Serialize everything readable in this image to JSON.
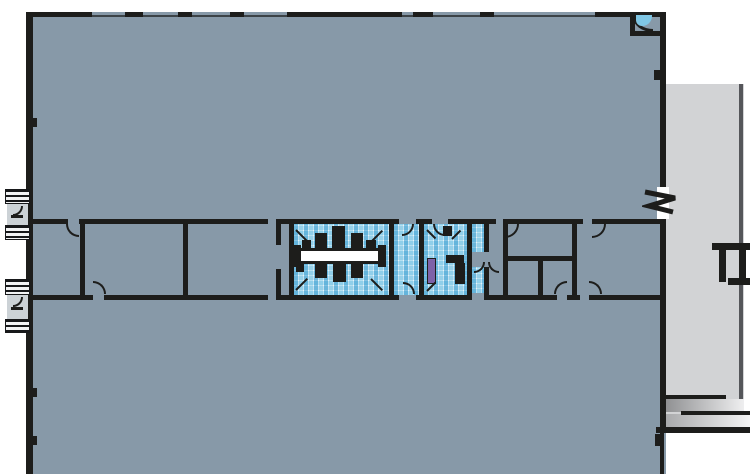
{
  "canvas": {
    "width": 750,
    "height": 474
  },
  "colors": {
    "background": "#ffffff",
    "floor": "#8799a8",
    "wing": "#d2d3d5",
    "wingEdge": "#55565a",
    "wall": "#1d1d1b",
    "wallThin": "#3c4347",
    "white": "#ffffff",
    "tileBase": "#bfe1f1",
    "tileMid": "#6fc0e4",
    "tileDark": "#3e9fd0",
    "basin": "#7fc6e4",
    "purple": "#7e62a8",
    "landing": "#ccd2d6",
    "rampDark": "#8f9092",
    "rampLight": "#efeff0"
  },
  "elements": [
    {
      "n": "main-floor-area",
      "x": 26,
      "y": 12,
      "w": 640,
      "h": 462,
      "f": "floor"
    },
    {
      "n": "right-wing-floor",
      "x": 666,
      "y": 84,
      "w": 78,
      "h": 346,
      "f": "wing"
    },
    {
      "n": "right-wing-edge-line",
      "x": 739,
      "y": 84,
      "w": 4,
      "h": 333,
      "f": "wingEdge"
    },
    {
      "n": "loading-ramp-upper",
      "x": 665,
      "y": 399,
      "w": 79,
      "h": 13,
      "g": [
        "#8f9092",
        "#efeff0"
      ]
    },
    {
      "n": "loading-ramp-lower",
      "x": 665,
      "y": 414,
      "w": 85,
      "h": 13,
      "g": [
        "#a8a9ab",
        "#f4f4f4"
      ]
    },
    {
      "n": "dock-edge-line",
      "x": 664,
      "y": 395,
      "w": 62,
      "h": 4,
      "f": "wall"
    },
    {
      "n": "dock-edge-line",
      "x": 681,
      "y": 411,
      "w": 69,
      "h": 4,
      "f": "wall"
    },
    {
      "n": "dock-edge-line",
      "x": 656,
      "y": 427,
      "w": 94,
      "h": 6,
      "f": "wall"
    },
    {
      "n": "restroom-tile-floor-west",
      "x": 294,
      "y": 224,
      "w": 95,
      "h": 71,
      "m": 1
    },
    {
      "n": "restroom-vestibule-tile",
      "x": 394,
      "y": 224,
      "w": 25,
      "h": 71,
      "m": 1
    },
    {
      "n": "restroom-tile-floor-east",
      "x": 424,
      "y": 224,
      "w": 43,
      "h": 71,
      "m": 1
    },
    {
      "n": "restroom-tile-sliver",
      "x": 472,
      "y": 224,
      "w": 12,
      "h": 28,
      "m": 1
    },
    {
      "n": "restroom-tile-sliver",
      "x": 472,
      "y": 267,
      "w": 12,
      "h": 26,
      "m": 1
    },
    {
      "n": "counter-edge",
      "x": 296,
      "y": 248,
      "w": 86,
      "h": 3,
      "f": "wall"
    },
    {
      "n": "restroom-counter",
      "x": 296,
      "y": 251,
      "w": 86,
      "h": 10,
      "f": "white"
    },
    {
      "n": "counter-edge",
      "x": 296,
      "y": 261,
      "w": 86,
      "h": 3,
      "f": "wall"
    },
    {
      "n": "counter-end-block",
      "x": 293,
      "y": 245,
      "w": 8,
      "h": 22,
      "f": "wall"
    },
    {
      "n": "counter-end-block",
      "x": 378,
      "y": 245,
      "w": 8,
      "h": 22,
      "f": "wall"
    },
    {
      "n": "plumbing-fixture",
      "x": 302,
      "y": 240,
      "w": 9,
      "h": 9,
      "f": "wall"
    },
    {
      "n": "plumbing-fixture",
      "x": 315,
      "y": 233,
      "w": 12,
      "h": 16,
      "f": "wall"
    },
    {
      "n": "plumbing-fixture",
      "x": 332,
      "y": 226,
      "w": 13,
      "h": 23,
      "f": "wall"
    },
    {
      "n": "plumbing-fixture",
      "x": 351,
      "y": 233,
      "w": 12,
      "h": 16,
      "f": "wall"
    },
    {
      "n": "plumbing-fixture",
      "x": 366,
      "y": 240,
      "w": 10,
      "h": 9,
      "f": "wall"
    },
    {
      "n": "plumbing-fixture",
      "x": 296,
      "y": 263,
      "w": 8,
      "h": 9,
      "f": "wall"
    },
    {
      "n": "plumbing-fixture",
      "x": 315,
      "y": 263,
      "w": 12,
      "h": 15,
      "f": "wall"
    },
    {
      "n": "plumbing-fixture",
      "x": 333,
      "y": 263,
      "w": 13,
      "h": 19,
      "f": "wall"
    },
    {
      "n": "plumbing-fixture",
      "x": 351,
      "y": 263,
      "w": 12,
      "h": 15,
      "f": "wall"
    },
    {
      "n": "plumbing-fixture",
      "x": 443,
      "y": 226,
      "w": 9,
      "h": 10,
      "f": "wall"
    },
    {
      "n": "plumbing-fixture",
      "x": 446,
      "y": 255,
      "w": 18,
      "h": 8,
      "f": "wall"
    },
    {
      "n": "plumbing-fixture",
      "x": 455,
      "y": 263,
      "w": 10,
      "h": 21,
      "f": "wall"
    },
    {
      "n": "drinking-fountain",
      "x": 427,
      "y": 258,
      "w": 9,
      "h": 26,
      "f": "purple",
      "bd": 1
    },
    {
      "n": "exterior-wall-top-thin",
      "x": 26,
      "y": 15,
      "w": 640,
      "h": 2,
      "f": "wallThin"
    },
    {
      "n": "exterior-wall-top",
      "x": 26,
      "y": 12,
      "w": 66,
      "h": 5,
      "f": "wall"
    },
    {
      "n": "exterior-wall-top",
      "x": 125,
      "y": 12,
      "w": 18,
      "h": 5,
      "f": "wall"
    },
    {
      "n": "exterior-wall-top",
      "x": 178,
      "y": 12,
      "w": 14,
      "h": 5,
      "f": "wall"
    },
    {
      "n": "exterior-wall-top",
      "x": 230,
      "y": 12,
      "w": 14,
      "h": 5,
      "f": "wall"
    },
    {
      "n": "exterior-wall-top",
      "x": 287,
      "y": 12,
      "w": 115,
      "h": 5,
      "f": "wall"
    },
    {
      "n": "exterior-wall-top",
      "x": 413,
      "y": 12,
      "w": 20,
      "h": 5,
      "f": "wall"
    },
    {
      "n": "exterior-wall-top",
      "x": 480,
      "y": 12,
      "w": 14,
      "h": 5,
      "f": "wall"
    },
    {
      "n": "exterior-wall-top",
      "x": 595,
      "y": 12,
      "w": 71,
      "h": 5,
      "f": "wall"
    },
    {
      "n": "exterior-wall-left",
      "x": 26,
      "y": 12,
      "w": 7,
      "h": 462,
      "f": "wall"
    },
    {
      "n": "exterior-wall-right",
      "x": 660,
      "y": 12,
      "w": 6,
      "h": 420,
      "f": "wall"
    },
    {
      "n": "exterior-wall-right-lower",
      "x": 660,
      "y": 432,
      "w": 4,
      "h": 42,
      "f": "wall"
    },
    {
      "n": "wall-column-tick",
      "x": 33,
      "y": 118,
      "w": 4,
      "h": 9,
      "f": "wall"
    },
    {
      "n": "wall-column-tick",
      "x": 33,
      "y": 388,
      "w": 4,
      "h": 9,
      "f": "wall"
    },
    {
      "n": "wall-column-tick",
      "x": 33,
      "y": 436,
      "w": 4,
      "h": 9,
      "f": "wall"
    },
    {
      "n": "wall-column-tick",
      "x": 655,
      "y": 434,
      "w": 5,
      "h": 12,
      "f": "wall"
    },
    {
      "n": "wall-end-cap",
      "x": 654,
      "y": 70,
      "w": 12,
      "h": 10,
      "f": "wall"
    },
    {
      "n": "corner-closet-wall",
      "x": 630,
      "y": 31,
      "w": 36,
      "h": 5,
      "f": "wall"
    },
    {
      "n": "corner-closet-wall",
      "x": 630,
      "y": 14,
      "w": 5,
      "h": 22,
      "f": "wall"
    },
    {
      "n": "corner-basin-outline",
      "x": 633,
      "y": 17,
      "w": 20,
      "h": 15,
      "q": "bl",
      "bw": 3
    },
    {
      "n": "corner-basin",
      "x": 636,
      "y": 15,
      "w": 16,
      "h": 11,
      "f": "basin",
      "rad": "0 0 10px 6px"
    },
    {
      "n": "interior-wall-h",
      "x": 32,
      "y": 219,
      "w": 36,
      "h": 5,
      "f": "wall"
    },
    {
      "n": "interior-wall-h",
      "x": 79,
      "y": 219,
      "w": 189,
      "h": 5,
      "f": "wall"
    },
    {
      "n": "interior-wall-h",
      "x": 280,
      "y": 219,
      "w": 119,
      "h": 5,
      "f": "wall"
    },
    {
      "n": "interior-wall-h",
      "x": 416,
      "y": 219,
      "w": 16,
      "h": 5,
      "f": "wall"
    },
    {
      "n": "interior-wall-h",
      "x": 448,
      "y": 219,
      "w": 48,
      "h": 5,
      "f": "wall"
    },
    {
      "n": "interior-wall-h",
      "x": 505,
      "y": 219,
      "w": 78,
      "h": 5,
      "f": "wall"
    },
    {
      "n": "interior-wall-h",
      "x": 592,
      "y": 219,
      "w": 68,
      "h": 5,
      "f": "wall"
    },
    {
      "n": "interior-wall-h",
      "x": 32,
      "y": 295,
      "w": 61,
      "h": 5,
      "f": "wall"
    },
    {
      "n": "interior-wall-h",
      "x": 104,
      "y": 295,
      "w": 164,
      "h": 5,
      "f": "wall"
    },
    {
      "n": "interior-wall-h",
      "x": 280,
      "y": 295,
      "w": 119,
      "h": 5,
      "f": "wall"
    },
    {
      "n": "interior-wall-h",
      "x": 416,
      "y": 295,
      "w": 56,
      "h": 5,
      "f": "wall"
    },
    {
      "n": "interior-wall-h",
      "x": 489,
      "y": 295,
      "w": 68,
      "h": 5,
      "f": "wall"
    },
    {
      "n": "interior-wall-h",
      "x": 567,
      "y": 295,
      "w": 13,
      "h": 5,
      "f": "wall"
    },
    {
      "n": "interior-wall-h",
      "x": 589,
      "y": 295,
      "w": 71,
      "h": 5,
      "f": "wall"
    },
    {
      "n": "interior-wall-h",
      "x": 508,
      "y": 256,
      "w": 64,
      "h": 5,
      "f": "wall"
    },
    {
      "n": "interior-wall-v",
      "x": 80,
      "y": 219,
      "w": 5,
      "h": 81,
      "f": "wall"
    },
    {
      "n": "interior-wall-v",
      "x": 183,
      "y": 219,
      "w": 5,
      "h": 81,
      "f": "wall"
    },
    {
      "n": "interior-wall-v",
      "x": 276,
      "y": 219,
      "w": 5,
      "h": 26,
      "f": "wall"
    },
    {
      "n": "interior-wall-v",
      "x": 276,
      "y": 269,
      "w": 5,
      "h": 31,
      "f": "wall"
    },
    {
      "n": "interior-wall-v",
      "x": 289,
      "y": 219,
      "w": 5,
      "h": 81,
      "f": "wall"
    },
    {
      "n": "interior-wall-v",
      "x": 389,
      "y": 224,
      "w": 5,
      "h": 71,
      "f": "wall"
    },
    {
      "n": "interior-wall-v",
      "x": 419,
      "y": 224,
      "w": 5,
      "h": 71,
      "f": "wall"
    },
    {
      "n": "interior-wall-v",
      "x": 467,
      "y": 219,
      "w": 5,
      "h": 81,
      "f": "wall"
    },
    {
      "n": "interior-wall-v",
      "x": 484,
      "y": 224,
      "w": 5,
      "h": 28,
      "f": "wall"
    },
    {
      "n": "interior-wall-v",
      "x": 484,
      "y": 267,
      "w": 5,
      "h": 33,
      "f": "wall"
    },
    {
      "n": "interior-wall-v",
      "x": 503,
      "y": 219,
      "w": 5,
      "h": 81,
      "f": "wall"
    },
    {
      "n": "interior-wall-v",
      "x": 538,
      "y": 258,
      "w": 5,
      "h": 42,
      "f": "wall"
    },
    {
      "n": "interior-wall-v",
      "x": 572,
      "y": 219,
      "w": 5,
      "h": 81,
      "f": "wall"
    },
    {
      "n": "door-swing",
      "x": 66,
      "y": 224,
      "w": 13,
      "h": 13,
      "q": "bl"
    },
    {
      "n": "door-swing",
      "x": 93,
      "y": 281,
      "w": 13,
      "h": 13,
      "q": "tr"
    },
    {
      "n": "door-swing",
      "x": 402,
      "y": 224,
      "w": 12,
      "h": 12,
      "q": "br"
    },
    {
      "n": "door-swing",
      "x": 403,
      "y": 282,
      "w": 12,
      "h": 12,
      "q": "tr"
    },
    {
      "n": "door-swing",
      "x": 433,
      "y": 224,
      "w": 12,
      "h": 12,
      "q": "bl"
    },
    {
      "n": "door-swing",
      "x": 505,
      "y": 224,
      "w": 14,
      "h": 14,
      "q": "br"
    },
    {
      "n": "door-swing",
      "x": 592,
      "y": 224,
      "w": 14,
      "h": 14,
      "q": "br"
    },
    {
      "n": "door-swing",
      "x": 554,
      "y": 281,
      "w": 13,
      "h": 13,
      "q": "tl"
    },
    {
      "n": "door-swing",
      "x": 589,
      "y": 281,
      "w": 13,
      "h": 13,
      "q": "tr"
    },
    {
      "n": "door-swing",
      "x": 474,
      "y": 262,
      "w": 11,
      "h": 11,
      "q": "br"
    },
    {
      "n": "door-swing",
      "x": 488,
      "y": 262,
      "w": 11,
      "h": 11,
      "q": "bl"
    },
    {
      "n": "stall-door-line",
      "x": 296,
      "y": 229,
      "w": 16,
      "h": 2,
      "r": 45,
      "f": "wall"
    },
    {
      "n": "stall-door-line",
      "x": 371,
      "y": 241,
      "w": 16,
      "h": 2,
      "r": -45,
      "f": "wall"
    },
    {
      "n": "stall-door-line",
      "x": 296,
      "y": 289,
      "w": 16,
      "h": 2,
      "r": -45,
      "f": "wall"
    },
    {
      "n": "stall-door-line",
      "x": 371,
      "y": 278,
      "w": 16,
      "h": 2,
      "r": 45,
      "f": "wall"
    },
    {
      "n": "stall-door-line",
      "x": 427,
      "y": 229,
      "w": 12,
      "h": 2,
      "r": 45,
      "f": "wall"
    },
    {
      "n": "stall-door-line",
      "x": 452,
      "y": 238,
      "w": 12,
      "h": 2,
      "r": -45,
      "f": "wall"
    },
    {
      "n": "stall-door-line",
      "x": 427,
      "y": 290,
      "w": 12,
      "h": 2,
      "r": -45,
      "f": "wall"
    },
    {
      "n": "entry-steps",
      "x": 5,
      "y": 189,
      "w": 25,
      "h": 15,
      "s": 1
    },
    {
      "n": "entry-landing",
      "x": 7,
      "y": 204,
      "w": 21,
      "h": 21,
      "f": "landing"
    },
    {
      "n": "entry-landing-arc",
      "x": 13,
      "y": 206,
      "w": 10,
      "h": 10,
      "q": "br"
    },
    {
      "n": "entry-step-line",
      "x": 11,
      "y": 215,
      "w": 12,
      "h": 3,
      "f": "wall"
    },
    {
      "n": "entry-steps",
      "x": 5,
      "y": 225,
      "w": 25,
      "h": 15,
      "s": 1
    },
    {
      "n": "entry-steps",
      "x": 5,
      "y": 279,
      "w": 25,
      "h": 16,
      "s": 1
    },
    {
      "n": "entry-landing",
      "x": 7,
      "y": 295,
      "w": 21,
      "h": 24,
      "f": "landing"
    },
    {
      "n": "entry-landing-arc",
      "x": 13,
      "y": 297,
      "w": 10,
      "h": 10,
      "q": "br"
    },
    {
      "n": "entry-step-line",
      "x": 11,
      "y": 307,
      "w": 12,
      "h": 3,
      "f": "wall"
    },
    {
      "n": "entry-steps",
      "x": 5,
      "y": 319,
      "w": 25,
      "h": 14,
      "s": 1
    },
    {
      "n": "stair-rail",
      "x": 712,
      "y": 243,
      "w": 38,
      "h": 7,
      "f": "wall"
    },
    {
      "n": "stair-rail",
      "x": 719,
      "y": 250,
      "w": 7,
      "h": 32,
      "f": "wall"
    },
    {
      "n": "stair-rail",
      "x": 739,
      "y": 250,
      "w": 7,
      "h": 32,
      "f": "wall"
    },
    {
      "n": "stair-rail",
      "x": 728,
      "y": 278,
      "w": 22,
      "h": 7,
      "f": "wall"
    }
  ]
}
